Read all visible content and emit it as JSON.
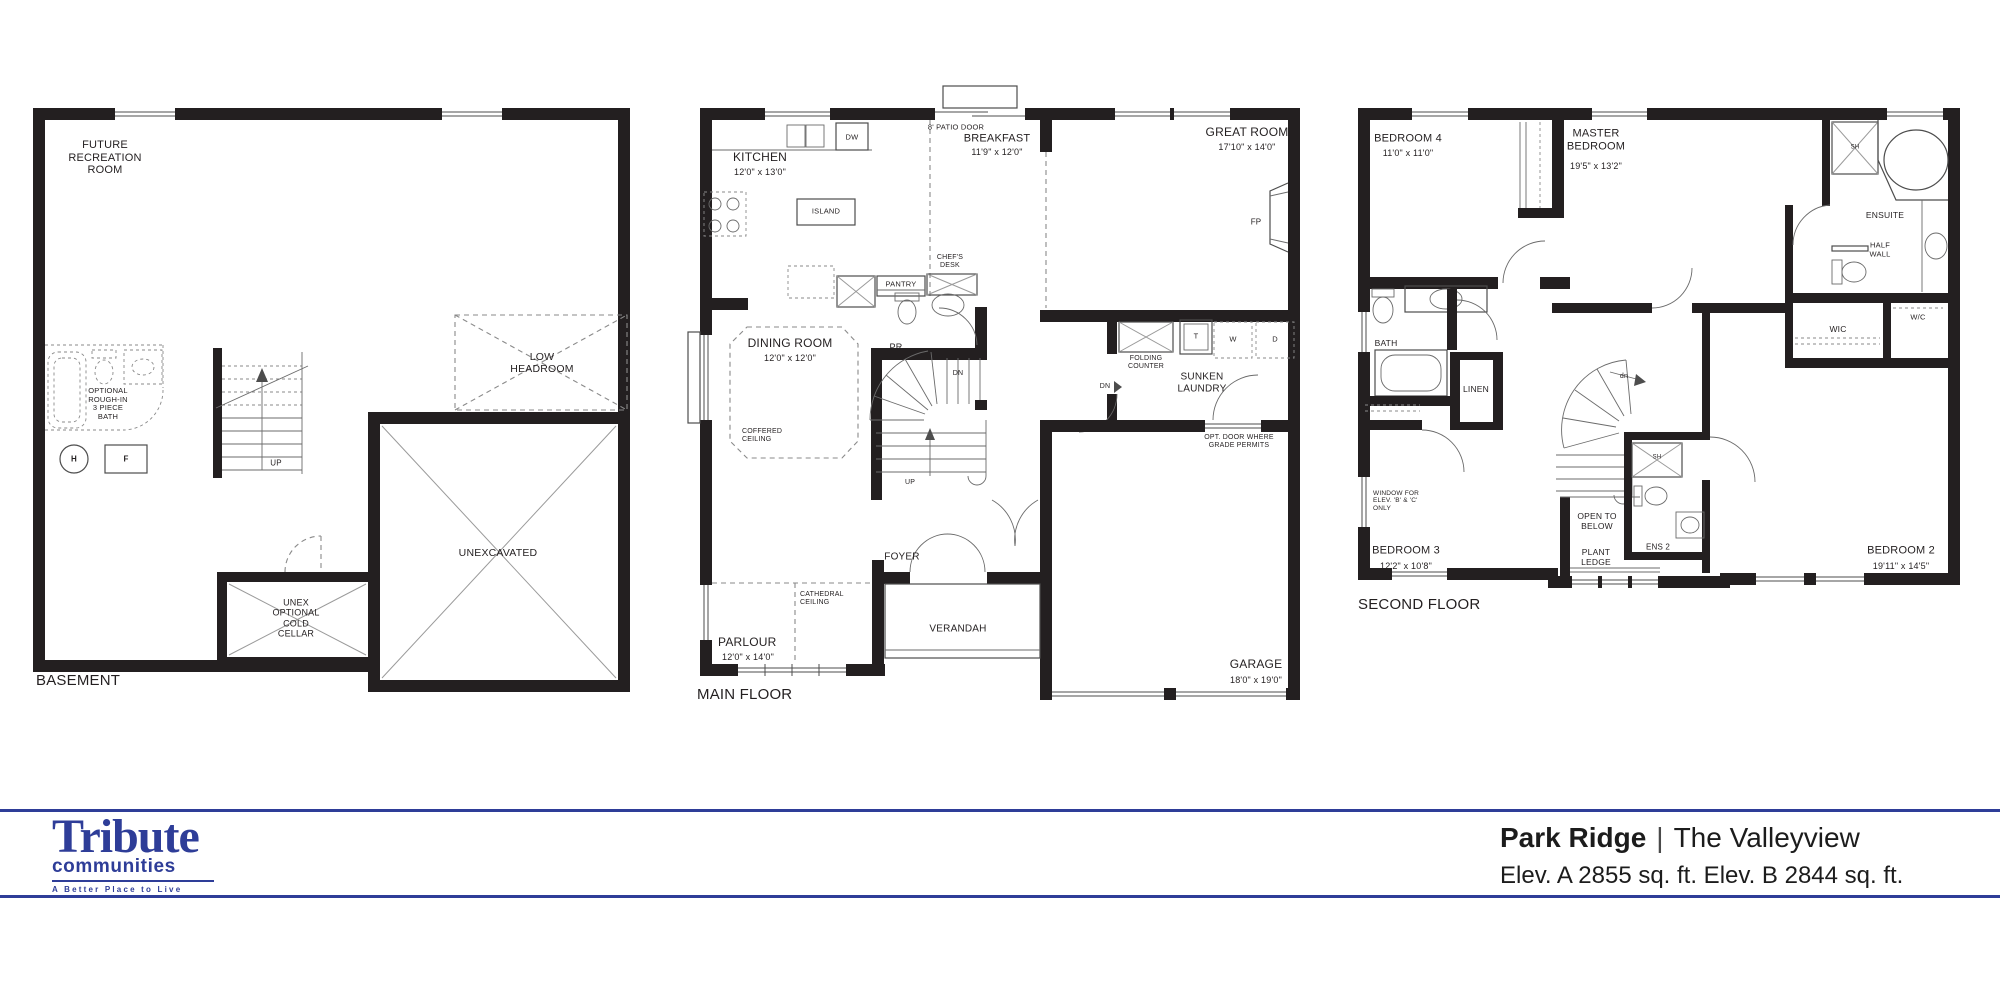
{
  "colors": {
    "ink": "#231f20",
    "accent_blue": "#2e3d98",
    "line_gray": "#8a8a8a"
  },
  "footer": {
    "brand": {
      "name": "Tribute",
      "sub": "communities",
      "tagline": "A Better Place to Live"
    },
    "plan_name": "Park Ridge",
    "separator": "|",
    "model_name": "The Valleyview",
    "elevations": "Elev. A 2855 sq. ft. Elev. B 2844 sq. ft."
  },
  "labels": [
    {
      "name": "future-recreation-room-label",
      "text": "FUTURE\nRECREATION\nROOM",
      "x": 105,
      "y": 158,
      "size": 11
    },
    {
      "name": "optional-bath-label",
      "text": "OPTIONAL\nROUGH-IN\n3 PIECE\nBATH",
      "x": 108,
      "y": 404,
      "size": 7.5
    },
    {
      "name": "water-heater-label",
      "text": "H",
      "x": 74,
      "y": 459,
      "size": 8,
      "bold": true
    },
    {
      "name": "furnace-label",
      "text": "F",
      "x": 126,
      "y": 459,
      "size": 8,
      "bold": true
    },
    {
      "name": "basement-up-label",
      "text": "UP",
      "x": 276,
      "y": 463,
      "size": 8
    },
    {
      "name": "low-headroom-label",
      "text": "LOW\nHEADROOM",
      "x": 542,
      "y": 363,
      "size": 10.5
    },
    {
      "name": "unexcavated-label",
      "text": "UNEXCAVATED",
      "x": 498,
      "y": 553,
      "size": 10.5
    },
    {
      "name": "cold-cellar-label",
      "text": "UNEX\nOPTIONAL\nCOLD\nCELLAR",
      "x": 296,
      "y": 618,
      "size": 9
    },
    {
      "name": "basement-title",
      "text": "BASEMENT",
      "x": 36,
      "y": 672,
      "size": 15,
      "align": "left"
    },
    {
      "name": "patio-door-label",
      "text": "8' PATIO DOOR",
      "x": 956,
      "y": 128,
      "size": 7.5
    },
    {
      "name": "dw-label",
      "text": "DW",
      "x": 852,
      "y": 138,
      "size": 7.5
    },
    {
      "name": "kitchen-label",
      "text": "KITCHEN",
      "x": 760,
      "y": 158,
      "size": 12
    },
    {
      "name": "kitchen-dims",
      "text": "12'0\" x 13'0\"",
      "x": 760,
      "y": 172,
      "size": 9
    },
    {
      "name": "island-label",
      "text": "ISLAND",
      "x": 826,
      "y": 212,
      "size": 7.5
    },
    {
      "name": "breakfast-label",
      "text": "BREAKFAST",
      "x": 997,
      "y": 139,
      "size": 11
    },
    {
      "name": "breakfast-dims",
      "text": "11'9\" x 12'0\"",
      "x": 997,
      "y": 152,
      "size": 9
    },
    {
      "name": "great-room-label",
      "text": "GREAT ROOM",
      "x": 1247,
      "y": 133,
      "size": 12
    },
    {
      "name": "great-room-dims",
      "text": "17'10\" x 14'0\"",
      "x": 1247,
      "y": 147,
      "size": 9
    },
    {
      "name": "fp-label",
      "text": "FP",
      "x": 1256,
      "y": 222,
      "size": 8
    },
    {
      "name": "chefs-desk-label",
      "text": "CHEF'S\nDESK",
      "x": 950,
      "y": 262,
      "size": 7
    },
    {
      "name": "pantry-label",
      "text": "PANTRY",
      "x": 901,
      "y": 285,
      "size": 7.5
    },
    {
      "name": "pr-label",
      "text": "PR",
      "x": 896,
      "y": 347,
      "size": 9
    },
    {
      "name": "dining-room-label",
      "text": "DINING ROOM",
      "x": 790,
      "y": 344,
      "size": 12
    },
    {
      "name": "dining-room-dims",
      "text": "12'0\" x 12'0\"",
      "x": 790,
      "y": 358,
      "size": 9
    },
    {
      "name": "coffered-ceiling-label",
      "text": "COFFERED\nCEILING",
      "x": 742,
      "y": 428,
      "size": 7,
      "align": "left"
    },
    {
      "name": "stairs-dn-label",
      "text": "DN",
      "x": 958,
      "y": 374,
      "size": 7
    },
    {
      "name": "stairs-up-label",
      "text": "UP",
      "x": 910,
      "y": 483,
      "size": 7
    },
    {
      "name": "folding-counter-label",
      "text": "FOLDING\nCOUNTER",
      "x": 1146,
      "y": 363,
      "size": 7
    },
    {
      "name": "laundry-tub-label",
      "text": "T",
      "x": 1196,
      "y": 337,
      "size": 7.5
    },
    {
      "name": "washer-label",
      "text": "W",
      "x": 1233,
      "y": 340,
      "size": 7.5
    },
    {
      "name": "dryer-label",
      "text": "D",
      "x": 1275,
      "y": 340,
      "size": 7.5
    },
    {
      "name": "sunken-laundry-label",
      "text": "SUNKEN\nLAUNDRY",
      "x": 1202,
      "y": 383,
      "size": 10
    },
    {
      "name": "laundry-dn-label",
      "text": "DN",
      "x": 1105,
      "y": 387,
      "size": 7
    },
    {
      "name": "opt-door-label",
      "text": "OPT. DOOR WHERE\nGRADE PERMITS",
      "x": 1239,
      "y": 442,
      "size": 7
    },
    {
      "name": "foyer-label",
      "text": "FOYER",
      "x": 902,
      "y": 557,
      "size": 10
    },
    {
      "name": "cathedral-ceiling-label",
      "text": "CATHEDRAL\nCEILING",
      "x": 800,
      "y": 591,
      "size": 7,
      "align": "left"
    },
    {
      "name": "verandah-label",
      "text": "VERANDAH",
      "x": 958,
      "y": 629,
      "size": 10
    },
    {
      "name": "parlour-label",
      "text": "PARLOUR",
      "x": 718,
      "y": 636,
      "size": 12,
      "align": "left"
    },
    {
      "name": "parlour-dims",
      "text": "12'0\" x 14'0\"",
      "x": 722,
      "y": 652,
      "size": 9,
      "align": "left"
    },
    {
      "name": "garage-label",
      "text": "GARAGE",
      "x": 1256,
      "y": 665,
      "size": 12
    },
    {
      "name": "garage-dims",
      "text": "18'0\" x 19'0\"",
      "x": 1256,
      "y": 680,
      "size": 9
    },
    {
      "name": "main-floor-title",
      "text": "MAIN FLOOR",
      "x": 697,
      "y": 686,
      "size": 15,
      "align": "left"
    },
    {
      "name": "bedroom4-label",
      "text": "BEDROOM 4",
      "x": 1408,
      "y": 139,
      "size": 11
    },
    {
      "name": "bedroom4-dims",
      "text": "11'0\" x 11'0\"",
      "x": 1408,
      "y": 153,
      "size": 9
    },
    {
      "name": "master-bedroom-label",
      "text": "MASTER\nBEDROOM",
      "x": 1596,
      "y": 140,
      "size": 11
    },
    {
      "name": "master-bedroom-dims",
      "text": "19'5\" x 13'2\"",
      "x": 1596,
      "y": 166,
      "size": 9
    },
    {
      "name": "ensuite-shower-label",
      "text": "SH",
      "x": 1855,
      "y": 148,
      "size": 6
    },
    {
      "name": "ensuite-label",
      "text": "ENSUITE",
      "x": 1885,
      "y": 216,
      "size": 8.5
    },
    {
      "name": "half-wall-label",
      "text": "HALF\nWALL",
      "x": 1880,
      "y": 250,
      "size": 7.5
    },
    {
      "name": "wc-label",
      "text": "W/C",
      "x": 1918,
      "y": 318,
      "size": 7.5
    },
    {
      "name": "wic-label",
      "text": "WIC",
      "x": 1838,
      "y": 330,
      "size": 8.5
    },
    {
      "name": "bath-label",
      "text": "BATH",
      "x": 1386,
      "y": 344,
      "size": 8.5
    },
    {
      "name": "linen-label",
      "text": "LINEN",
      "x": 1476,
      "y": 390,
      "size": 8.5
    },
    {
      "name": "stairs-dn2-label",
      "text": "dn",
      "x": 1624,
      "y": 377,
      "size": 7
    },
    {
      "name": "window-elev-note",
      "text": "WINDOW FOR\nELEV. 'B' & 'C'\nONLY",
      "x": 1373,
      "y": 490,
      "size": 6.5,
      "align": "left"
    },
    {
      "name": "bedroom3-label",
      "text": "BEDROOM 3",
      "x": 1406,
      "y": 551,
      "size": 11
    },
    {
      "name": "bedroom3-dims",
      "text": "12'2\" x 10'8\"",
      "x": 1406,
      "y": 566,
      "size": 9
    },
    {
      "name": "open-to-below-label",
      "text": "OPEN TO\nBELOW",
      "x": 1597,
      "y": 522,
      "size": 8.5
    },
    {
      "name": "plant-ledge-label",
      "text": "PLANT\nLEDGE",
      "x": 1596,
      "y": 558,
      "size": 8.5
    },
    {
      "name": "ens2-label",
      "text": "ENS 2",
      "x": 1658,
      "y": 547,
      "size": 8
    },
    {
      "name": "ens2-shower-label",
      "text": "SH",
      "x": 1657,
      "y": 458,
      "size": 6
    },
    {
      "name": "bedroom2-label",
      "text": "BEDROOM 2",
      "x": 1901,
      "y": 551,
      "size": 11
    },
    {
      "name": "bedroom2-dims",
      "text": "19'11\" x 14'5\"",
      "x": 1901,
      "y": 566,
      "size": 9
    },
    {
      "name": "second-floor-title",
      "text": "SECOND FLOOR",
      "x": 1358,
      "y": 596,
      "size": 15,
      "align": "left"
    }
  ]
}
